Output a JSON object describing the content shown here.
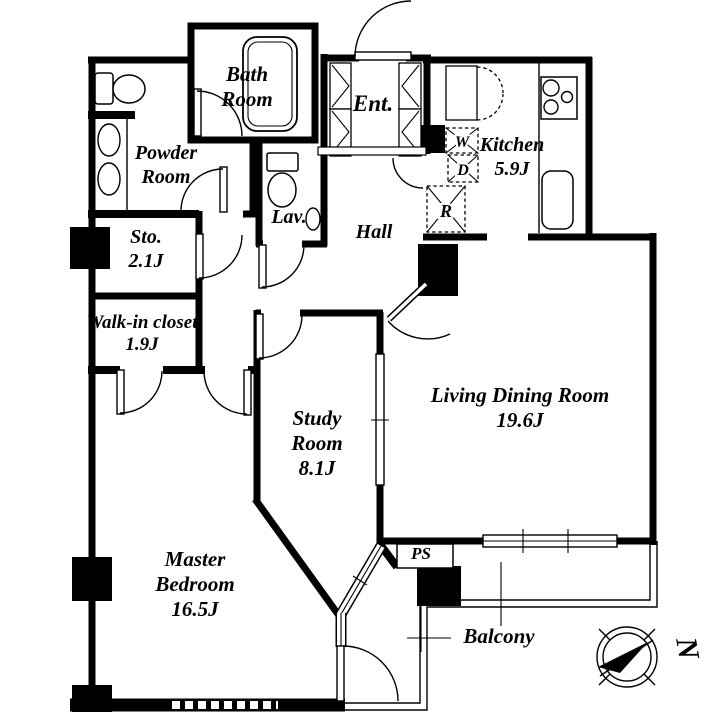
{
  "floorplan": {
    "rooms": {
      "bath": {
        "name": "Bath Room",
        "area": ""
      },
      "powder": {
        "name": "Powder Room",
        "area": ""
      },
      "entrance": {
        "name": "Ent.",
        "area": ""
      },
      "kitchen": {
        "name": "Kitchen",
        "area": "5.9J"
      },
      "storage": {
        "name": "Sto.",
        "area": "2.1J"
      },
      "wic": {
        "name": "Walk-in closet",
        "area": "1.9J"
      },
      "lavatory": {
        "name": "Lav.",
        "area": ""
      },
      "hall": {
        "name": "Hall",
        "area": ""
      },
      "study": {
        "name": "Study Room",
        "area": "8.1J"
      },
      "ldr": {
        "name": "Living Dining Room",
        "area": "19.6J"
      },
      "master": {
        "name": "Master Bedroom",
        "area": "16.5J"
      },
      "ps": {
        "name": "PS",
        "area": ""
      },
      "balcony": {
        "name": "Balcony",
        "area": ""
      }
    },
    "appliances": {
      "washer": "W",
      "dryer": "D",
      "refrigerator": "R"
    },
    "compass": {
      "direction": "N"
    },
    "colors": {
      "wall": "#000000",
      "floor": "#ffffff"
    }
  }
}
